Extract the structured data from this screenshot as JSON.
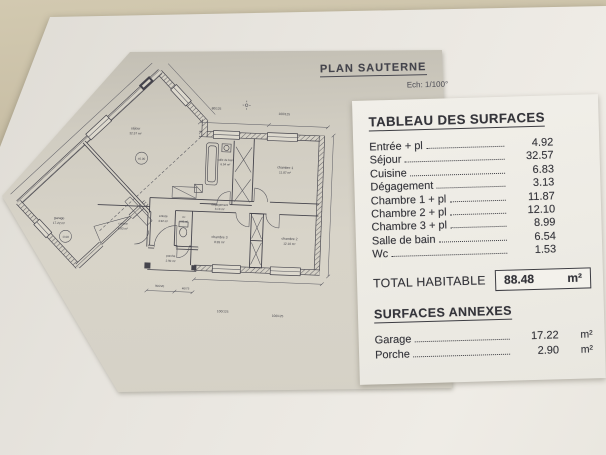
{
  "plan_sheet": {
    "title": "PLAN SAUTERNE",
    "scale_label": "Ech: 1/100°",
    "rooms": [
      {
        "name": "séjour",
        "area": "32.57 m²"
      },
      {
        "name": "garage",
        "area": "17.22 m²"
      },
      {
        "name": "cuisine",
        "area": "6.83 m²"
      },
      {
        "name": "entrée",
        "area": "4.92 m²"
      },
      {
        "name": "wc",
        "area": "1.53 m²"
      },
      {
        "name": "salle de bain",
        "area": "6.54 m²"
      },
      {
        "name": "dégagement",
        "area": "3.13 m²"
      },
      {
        "name": "chambre 1",
        "area": "11.87 m²"
      },
      {
        "name": "chambre 2",
        "area": "12.10 m²"
      },
      {
        "name": "chambre 3",
        "area": "8.99 m²"
      },
      {
        "name": "porche",
        "area": "2.90 m²"
      }
    ],
    "levels": {
      "sejour": "±0.00",
      "garage": "-0.08"
    },
    "dims": {
      "top_1": "80/125",
      "top_2": "100/125",
      "bottom_1": "100/125",
      "bottom_2": "100/125",
      "porch_1": "90/220",
      "porch_2": "40/75"
    }
  },
  "surface_table": {
    "title": "TABLEAU DES SURFACES",
    "rows": [
      {
        "label": "Entrée + pl",
        "value": "4.92"
      },
      {
        "label": "Séjour",
        "value": "32.57"
      },
      {
        "label": "Cuisine",
        "value": "6.83"
      },
      {
        "label": "Dégagement",
        "value": "3.13"
      },
      {
        "label": "Chambre 1 + pl",
        "value": "11.87"
      },
      {
        "label": "Chambre 2 + pl",
        "value": "12.10"
      },
      {
        "label": "Chambre 3 + pl",
        "value": "8.99"
      },
      {
        "label": "Salle de bain",
        "value": "6.54"
      },
      {
        "label": "Wc",
        "value": "1.53"
      }
    ],
    "total": {
      "label": "TOTAL HABITABLE",
      "value": "88.48",
      "unit": "m²"
    },
    "annex_title": "SURFACES ANNEXES",
    "annex_rows": [
      {
        "label": "Garage",
        "value": "17.22",
        "unit": "m²"
      },
      {
        "label": "Porche",
        "value": "2.90",
        "unit": "m²"
      }
    ]
  }
}
